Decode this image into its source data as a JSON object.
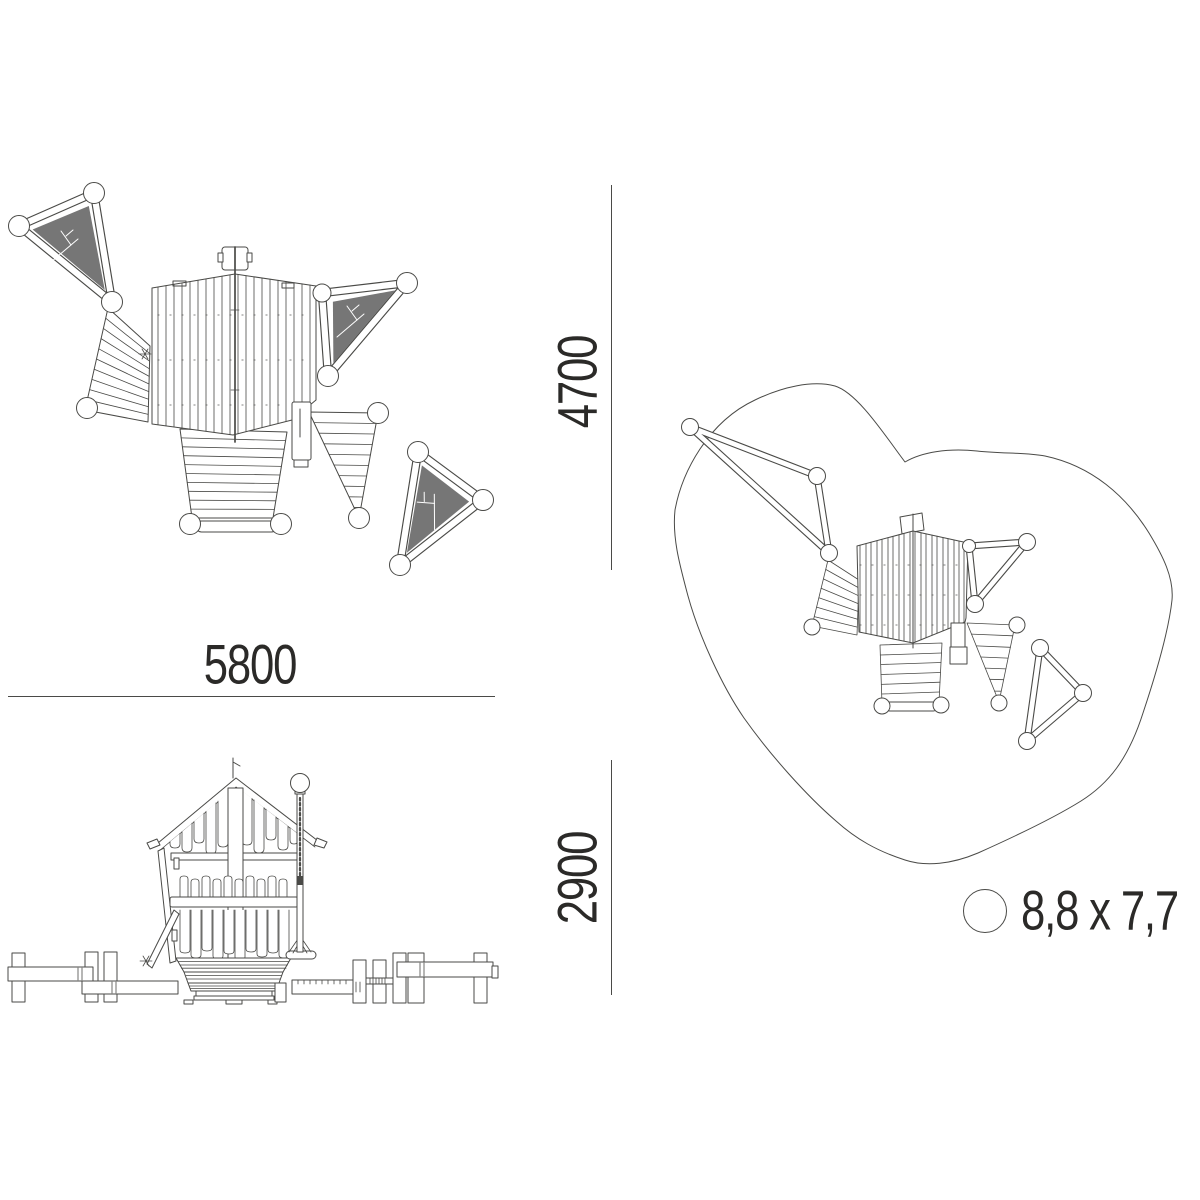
{
  "dimensions": {
    "plan_width": "5800",
    "plan_depth": "4700",
    "elevation_height": "2900"
  },
  "legend": {
    "space_requirement": "8,8 x 7,7"
  },
  "colors": {
    "background": "#ffffff",
    "line": "#4a4a47",
    "text": "#2b2a28",
    "sail_fill": "#767676"
  }
}
